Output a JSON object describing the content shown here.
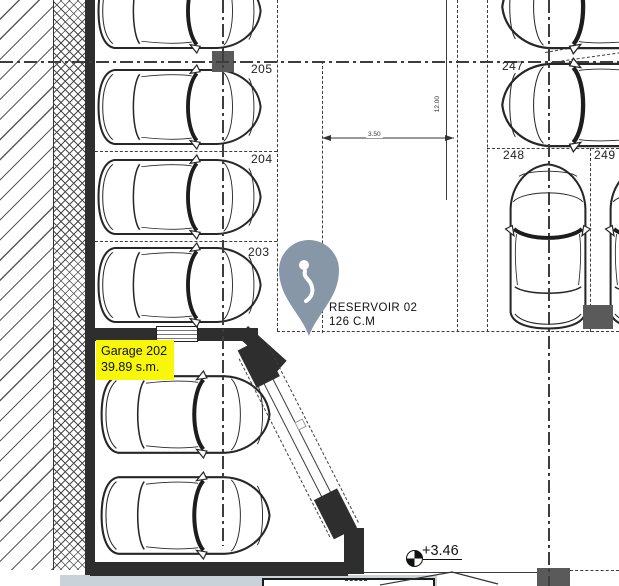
{
  "drawing_title": "parking-garage-floor-plan",
  "spots": {
    "s205": "205",
    "s204": "204",
    "s203": "203",
    "s247": "247",
    "s248": "248",
    "s249": "249"
  },
  "garage": {
    "name": "Garage 202",
    "area": "39.89 s.m."
  },
  "reservoir": {
    "name": "RESERVOIR 02",
    "volume": "126 C.M"
  },
  "elevation": {
    "value": "+3.46"
  },
  "dimensions": {
    "horizontal": "3.50",
    "vertical": "12.00"
  },
  "icons": {
    "pin": "location-pin-icon",
    "pin_glyph": "hook-icon",
    "level": "level-marker-icon"
  },
  "colors": {
    "wall": "#2e2e2e",
    "column": "#5a5a5a",
    "pin": "#8797a7",
    "highlight": "#f8f70a",
    "band": "#c9d2d9"
  }
}
